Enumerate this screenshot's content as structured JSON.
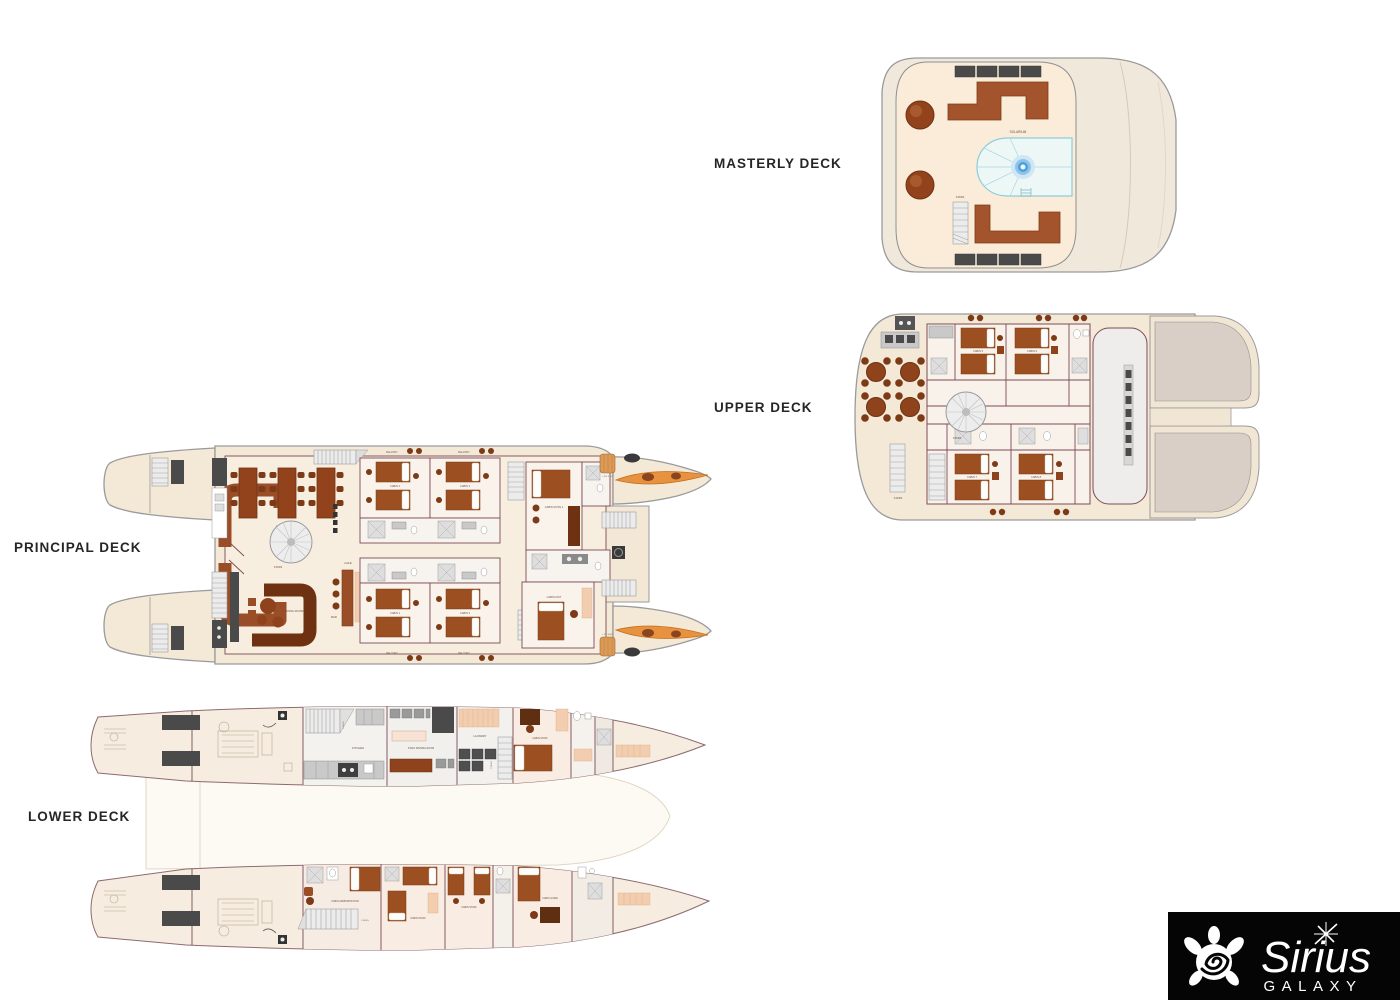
{
  "decks": {
    "masterly": {
      "title": "MASTERLY DECK",
      "labels": {
        "solarium": "SOLARIUM",
        "stairs": "STAIRS"
      }
    },
    "upper": {
      "title": "UPPER DECK",
      "labels": {
        "cabin5": "CABIN 5",
        "cabin6": "CABIN 6",
        "cabin7": "CABIN 7",
        "cabin8": "CABIN 8",
        "stairs": "STAIRS"
      }
    },
    "principal": {
      "title": "PRINCIPAL DECK",
      "labels": {
        "dining_room": "DINING ROOM",
        "stairs": "STAIRS",
        "living_room": "LIVING ROOM",
        "cafe": "CAFE",
        "bar": "BAR",
        "balcony": "BALCONY",
        "cabin1": "CABIN 1",
        "cabin2": "CABIN 2",
        "cabin3": "CABIN 3",
        "cabin4": "CABIN 4",
        "cabin_suite1": "CABIN SUITE 1",
        "cabin_unit": "CABIN UNIT",
        "life_raft": "LIFE RAFT"
      }
    },
    "lower": {
      "title": "LOWER DECK",
      "labels": {
        "kitchen": "KITCHEN",
        "staff_dining": "STAFF DINNING ROOM",
        "laundry": "LAUNDRY",
        "stairs": "STAIRS",
        "cabin_staff": "CABIN STAFF",
        "cabin_administrator": "CABIN ADMINISTRATOR",
        "cabin_guide": "CABIN GUIDE"
      }
    }
  },
  "logo": {
    "brand": "Sirius",
    "subtitle": "GALAXY"
  },
  "colors": {
    "furniture_brown": "#9c4f21",
    "sofa_brown": "#8e431c",
    "deck_cream": "#f6ead8",
    "wall_maroon": "#7b4b57",
    "pool_line": "#85cbd8",
    "jacuzzi_blue": "#3f96d2",
    "kayak_orange": "#e8923f",
    "dark_gray": "#4a4a4a",
    "logo_bg": "#050505"
  }
}
